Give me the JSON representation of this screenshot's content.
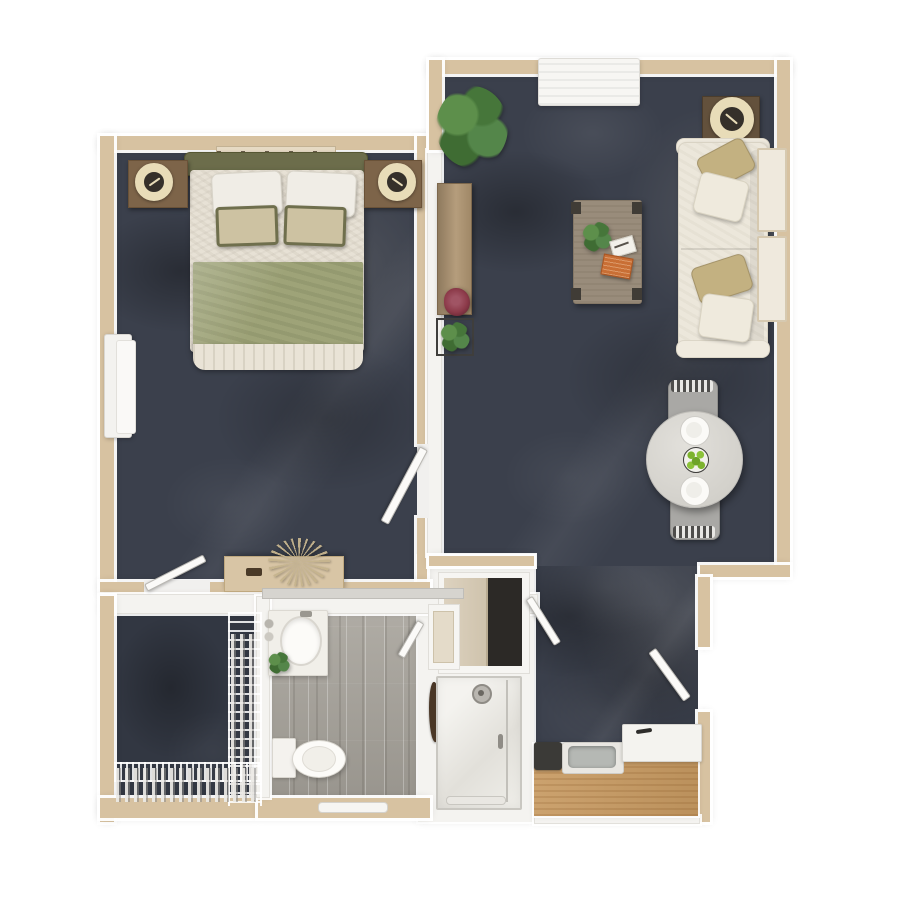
{
  "image": {
    "type": "apartment-floor-plan-3d-render",
    "view": "top-down",
    "visible_text": ""
  },
  "rooms": [
    {
      "id": "bedroom",
      "furniture": [
        "queen-bed",
        "headboard",
        "pillows",
        "accent-pillows",
        "sage-blanket",
        "nightstand-left",
        "nightstand-right",
        "table-lamp-left",
        "table-lamp-right",
        "wall-shelf",
        "dresser-console",
        "pampas-plant",
        "radiator",
        "bedroom-door",
        "closet-door-leaf"
      ]
    },
    {
      "id": "living-room",
      "furniture": [
        "sectional-sofa",
        "throw-pillows",
        "corner-side-table",
        "table-lamp",
        "coffee-table",
        "notepad",
        "orange-book",
        "potted-plant-large",
        "media-console",
        "berry-plant",
        "square-planter",
        "window-ac-unit",
        "wall-windows",
        "dining-table",
        "dining-chair-top",
        "dining-chair-bottom",
        "place-setting-top",
        "place-setting-bottom",
        "fruit-bowl"
      ]
    },
    {
      "id": "entry-hall",
      "furniture": [
        "entry-door-leaf",
        "hall-door-leaf"
      ]
    },
    {
      "id": "kitchenette",
      "furniture": [
        "wood-counter",
        "sink-basin",
        "cooktop",
        "mini-fridge"
      ]
    },
    {
      "id": "bathroom",
      "furniture": [
        "vanity-counter",
        "oval-basin",
        "faucet",
        "small-plant",
        "toilet",
        "towel-bar",
        "bathroom-door-leaf",
        "robe-hook"
      ]
    },
    {
      "id": "shower-room",
      "furniture": [
        "walk-in-shower",
        "shower-head",
        "glass-panel",
        "shower-handle",
        "shower-towel-bar"
      ]
    },
    {
      "id": "closet",
      "furniture": [
        "wire-rack-side",
        "wire-rack-bottom",
        "hanging-clothes"
      ]
    },
    {
      "id": "entry-closet",
      "furniture": [
        "sliding-door-beige",
        "dark-interior",
        "niche-shelf"
      ]
    }
  ],
  "colors": {
    "wall": "#d7c2a1",
    "wallEdge": "#c0a883",
    "white": "#f4f3f0",
    "carpet": "#3b404c",
    "carpetDark": "#323742",
    "plank": "#a6a29a",
    "wood": "#c79a62",
    "cream": "#e8dcb8",
    "olive": "#6c6d4b",
    "sage": "#9ea378",
    "tanPillow": "#c3b181",
    "duvet": "#e7e1d5",
    "woodDark": "#63513c",
    "woodMid": "#b29a78",
    "tableGray": "#d9d7d2",
    "chairGray": "#a9a8a5",
    "plantGreen": "#47703c",
    "fruitGreen": "#7db32e",
    "bookOrange": "#c96f35",
    "berryRed": "#8c3a49"
  }
}
